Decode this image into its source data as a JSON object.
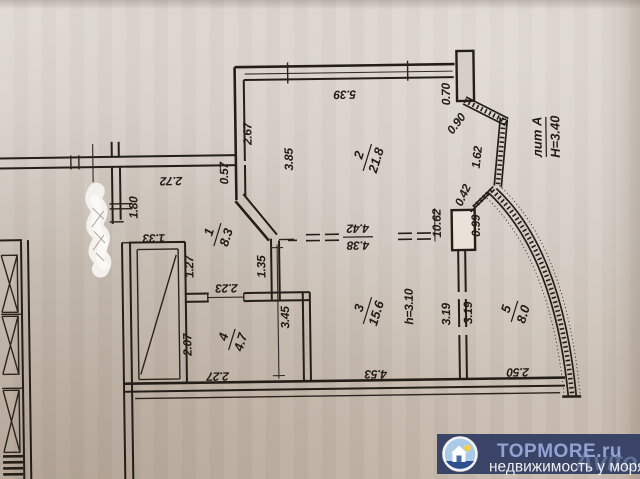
{
  "plan": {
    "rooms": [
      {
        "number": "1",
        "area": "8.3"
      },
      {
        "number": "2",
        "area": "21.8"
      },
      {
        "number": "3",
        "area": "15.6"
      },
      {
        "number": "4",
        "area": "4.7"
      },
      {
        "number": "5",
        "area": "8.0"
      }
    ],
    "building_label": {
      "liter": "лит А",
      "height": "Н=3.40"
    },
    "ceiling_height": "h=3.10",
    "dims": {
      "d539": "5.39",
      "d267": "2.67",
      "d385": "3.85",
      "d272": "2.72",
      "d057": "0.57",
      "d180": "1.80",
      "d133": "1.33",
      "d127": "1.27",
      "d135": "1.35",
      "d223": "2.23",
      "d345": "3.45",
      "d207": "2.07",
      "d227": "2.27",
      "d453": "4.53",
      "d250": "2.50",
      "d319a": "3.19",
      "d319b": "3.19",
      "d442": "4.42",
      "d438": "4.38",
      "d070": "0.70",
      "d090": "0.90",
      "d162": "1.62",
      "d042": "0.42",
      "d1062": "10.62",
      "d099": "0.99"
    }
  },
  "watermark": {
    "brand": "TOPMORE.ru",
    "tagline": "недвижимость у моря",
    "ghost": "Avito",
    "panel_color": "#3a4466",
    "brand_color": "#92a2d2",
    "tagline_color": "#efefef"
  }
}
